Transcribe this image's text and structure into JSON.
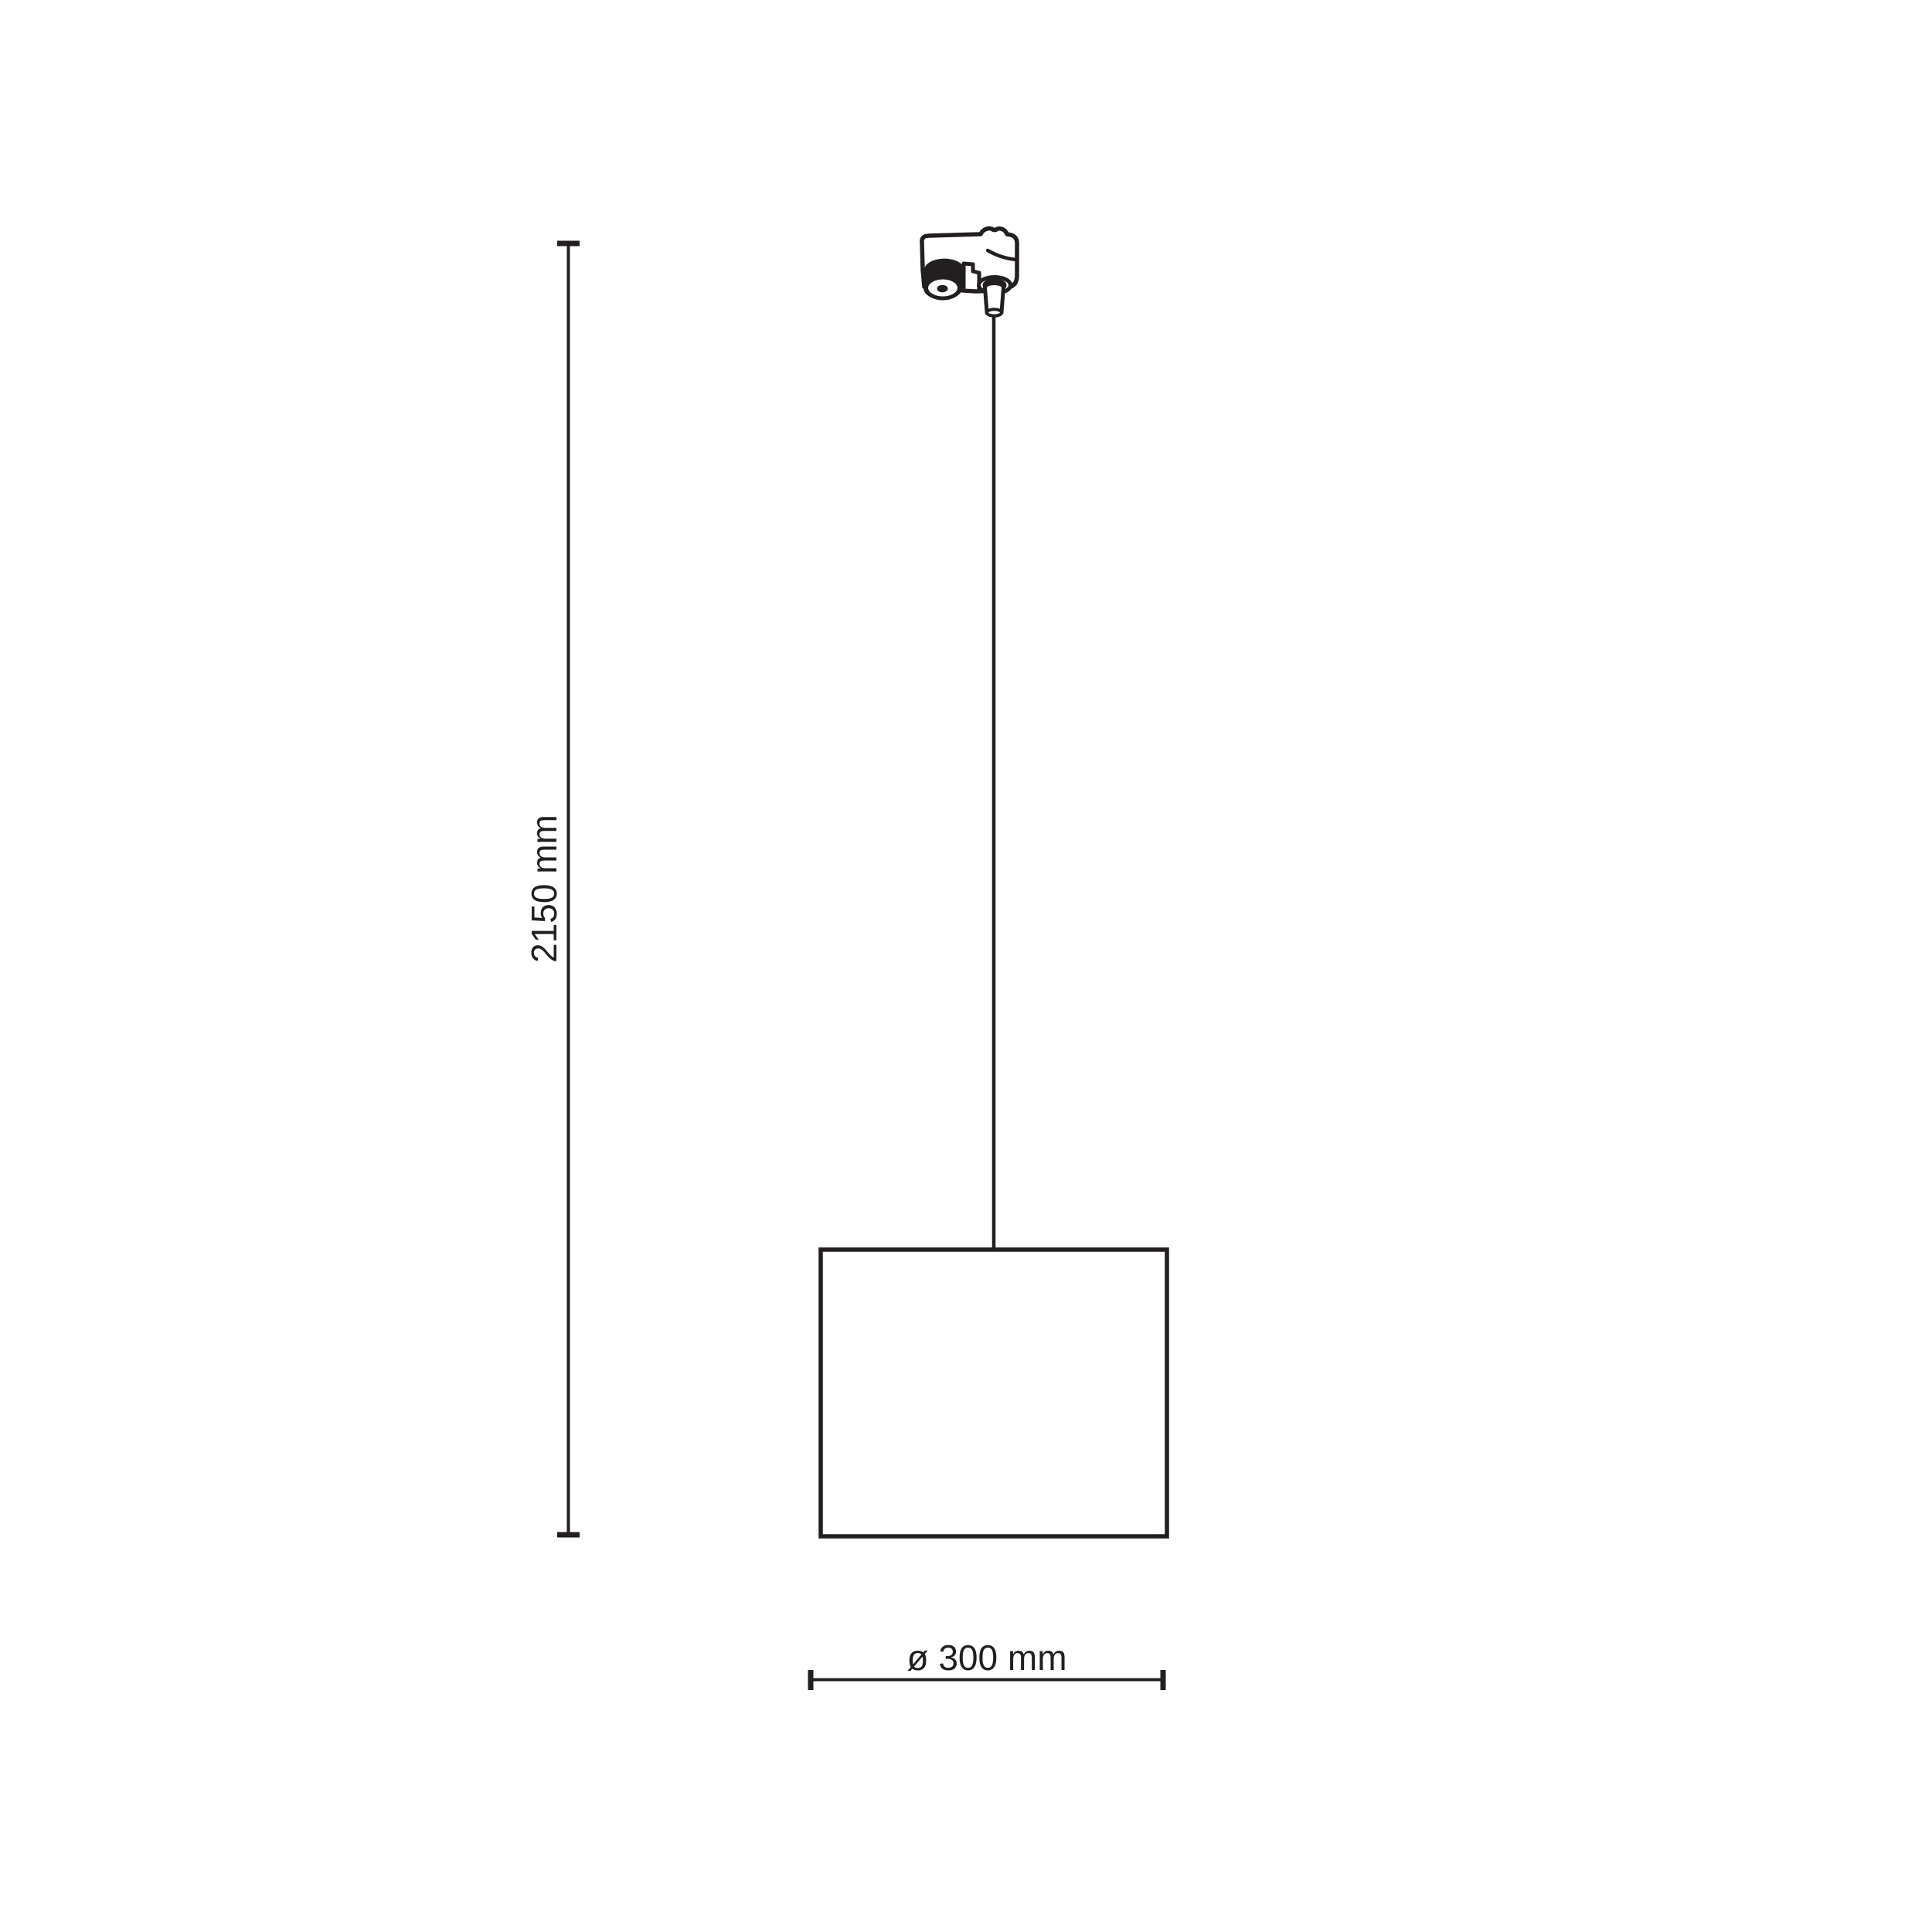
{
  "drawing": {
    "height_dimension": {
      "label": "2150 mm",
      "value_mm": 2150,
      "orientation": "vertical"
    },
    "diameter_dimension": {
      "label": "ø 300 mm",
      "value_mm": 300,
      "orientation": "horizontal"
    }
  },
  "colors": {
    "ink": "#231f20",
    "background": "#ffffff"
  }
}
